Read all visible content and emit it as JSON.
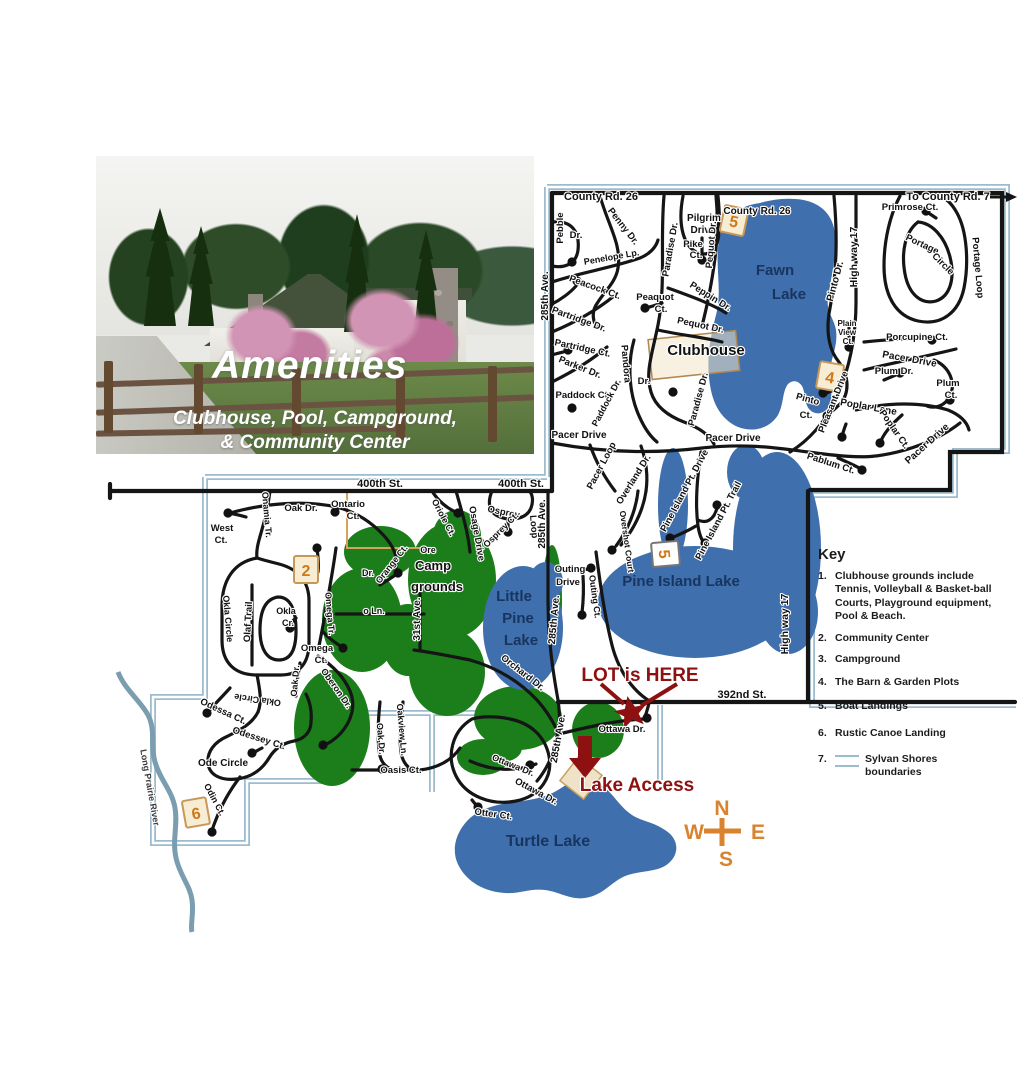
{
  "colors": {
    "lake": "#3f6fad",
    "navy": "#17355e",
    "green": "#1b7e1b",
    "maroon": "#8e1111",
    "orange": "#d9832e",
    "marker_text": "#d07818",
    "marker_fill": "#f7ecd4",
    "marker_border": "#c89858",
    "boundary": "#9cbccd",
    "river": "#7a9db0",
    "road": "#151515",
    "tan": "#d9a05c",
    "gray": "#3a3a3a"
  },
  "photo": {
    "title": "Amenities",
    "subtitle1": "Clubhouse, Pool, Campground,",
    "subtitle2": "& Community Center"
  },
  "key": {
    "title": "Key",
    "items": [
      {
        "num": "1.",
        "text": "Clubhouse grounds include Tennis, Volleyball  & Basket-ball Courts, Playground equipment,  Pool & Beach."
      },
      {
        "num": "2.",
        "text": "Community Center"
      },
      {
        "num": "3.",
        "text": "Campground"
      },
      {
        "num": "4.",
        "text": "The Barn & Garden Plots"
      },
      {
        "num": "5.",
        "text": "Boat Landings"
      },
      {
        "num": "6.",
        "text": "Rustic Canoe Landing"
      },
      {
        "num": "7.",
        "text": "Sylvan Shores boundaries"
      }
    ]
  },
  "map": {
    "markers": [
      {
        "label": "5",
        "x": 734,
        "y": 221,
        "r": 12
      },
      {
        "label": "4",
        "x": 830,
        "y": 377,
        "r": 10
      },
      {
        "label": "5",
        "x": 665,
        "y": 554,
        "r": 85,
        "variant": "light"
      },
      {
        "label": "2",
        "x": 306,
        "y": 570,
        "r": 0
      },
      {
        "label": "6",
        "x": 196,
        "y": 813,
        "r": -10
      }
    ],
    "labels": [
      {
        "t": "County Rd. 26",
        "x": 601,
        "y": 200,
        "s": 11
      },
      {
        "t": "To County Rd. 7",
        "x": 948,
        "y": 200,
        "s": 11
      },
      {
        "t": "County Rd. 26",
        "x": 757,
        "y": 214,
        "s": 10
      },
      {
        "t": "Primrose Ct.",
        "x": 910,
        "y": 210,
        "s": 9.5
      },
      {
        "t": "Pilgrim",
        "x": 704,
        "y": 221,
        "s": 10
      },
      {
        "t": "Drive",
        "x": 703,
        "y": 233,
        "s": 10
      },
      {
        "t": "Pike",
        "x": 693,
        "y": 247,
        "s": 9.5
      },
      {
        "t": "Ct.",
        "x": 696,
        "y": 258,
        "s": 9.5
      },
      {
        "t": "Pebble",
        "x": 563,
        "y": 228,
        "r": -90,
        "s": 9.5
      },
      {
        "t": "Dr.",
        "x": 576,
        "y": 238,
        "s": 9.5
      },
      {
        "t": "Penny Dr.",
        "x": 621,
        "y": 228,
        "r": 52,
        "s": 9.5
      },
      {
        "t": "Penelope Lp.",
        "x": 612,
        "y": 260,
        "r": -10,
        "s": 9
      },
      {
        "t": "Peacock Ct.",
        "x": 594,
        "y": 290,
        "r": 20,
        "s": 9.5
      },
      {
        "t": "Paradise Dr.",
        "x": 673,
        "y": 250,
        "r": -80,
        "s": 9.5
      },
      {
        "t": "Pequot Dr.",
        "x": 714,
        "y": 245,
        "r": -85,
        "s": 9.5
      },
      {
        "t": "Fawn",
        "x": 775,
        "y": 275,
        "s": 15,
        "f": "navy"
      },
      {
        "t": "Lake",
        "x": 789,
        "y": 299,
        "s": 15,
        "f": "navy"
      },
      {
        "t": "Pinto Dr.",
        "x": 838,
        "y": 282,
        "r": -75,
        "s": 10
      },
      {
        "t": "High way 17",
        "x": 857,
        "y": 257,
        "r": -90,
        "s": 10.5
      },
      {
        "t": "Portage",
        "x": 921,
        "y": 247,
        "r": 25,
        "s": 9.5
      },
      {
        "t": "Circle",
        "x": 941,
        "y": 266,
        "r": 45,
        "s": 9.5
      },
      {
        "t": "Portage Loop",
        "x": 975,
        "y": 268,
        "r": 85,
        "s": 9.5
      },
      {
        "t": "Peaquot",
        "x": 655,
        "y": 300,
        "s": 9.5
      },
      {
        "t": "Ct.",
        "x": 661,
        "y": 312,
        "s": 9.5
      },
      {
        "t": "Partridge Dr.",
        "x": 578,
        "y": 322,
        "r": 20,
        "s": 9.5
      },
      {
        "t": "Peppin Dr.",
        "x": 709,
        "y": 299,
        "r": 32,
        "s": 9.5
      },
      {
        "t": "Pequot Dr.",
        "x": 700,
        "y": 328,
        "r": 12,
        "s": 9.5
      },
      {
        "t": "Plain",
        "x": 847,
        "y": 326,
        "s": 8
      },
      {
        "t": "View",
        "x": 847,
        "y": 335,
        "s": 8
      },
      {
        "t": "Ct.",
        "x": 848,
        "y": 344,
        "s": 8
      },
      {
        "t": "Porcupine Ct.",
        "x": 917,
        "y": 340,
        "s": 9.5
      },
      {
        "t": "Partridge Ct.",
        "x": 582,
        "y": 351,
        "r": 12,
        "s": 9.5
      },
      {
        "t": "Parker Dr.",
        "x": 579,
        "y": 370,
        "r": 22,
        "s": 9.5
      },
      {
        "t": "Clubhouse",
        "x": 706,
        "y": 355,
        "s": 15,
        "w": 800
      },
      {
        "t": "Pacer Drive",
        "x": 909,
        "y": 362,
        "r": 10,
        "s": 10
      },
      {
        "t": "Plum Dr.",
        "x": 894,
        "y": 374,
        "s": 9.5
      },
      {
        "t": "Plum",
        "x": 948,
        "y": 386,
        "s": 9.5
      },
      {
        "t": "Ct.",
        "x": 951,
        "y": 398,
        "s": 9.5
      },
      {
        "t": "Pandora",
        "x": 623,
        "y": 364,
        "r": 85,
        "s": 9.5
      },
      {
        "t": "Dr.",
        "x": 644,
        "y": 384,
        "s": 9.5
      },
      {
        "t": "Paddock Ct.",
        "x": 583,
        "y": 398,
        "s": 9.5
      },
      {
        "t": "Paddock Dr.",
        "x": 609,
        "y": 404,
        "r": -62,
        "s": 9
      },
      {
        "t": "Paradise Dr.",
        "x": 701,
        "y": 400,
        "r": -75,
        "s": 9.5
      },
      {
        "t": "Pinto",
        "x": 807,
        "y": 402,
        "r": 15,
        "s": 9.5
      },
      {
        "t": "Ct.",
        "x": 806,
        "y": 418,
        "s": 9.5
      },
      {
        "t": "Pleasant Drive",
        "x": 836,
        "y": 403,
        "r": -68,
        "s": 9.5
      },
      {
        "t": "Poplar Lane",
        "x": 868,
        "y": 410,
        "r": 10,
        "s": 10
      },
      {
        "t": "Poplar Ct.",
        "x": 892,
        "y": 431,
        "r": 55,
        "s": 9.5
      },
      {
        "t": "Pacer Drive",
        "x": 929,
        "y": 446,
        "r": -42,
        "s": 10
      },
      {
        "t": "Pacer Drive",
        "x": 579,
        "y": 438,
        "s": 10
      },
      {
        "t": "Pacer Drive",
        "x": 733,
        "y": 441,
        "s": 10
      },
      {
        "t": "Pacer Loop",
        "x": 604,
        "y": 467,
        "r": -62,
        "s": 9.5
      },
      {
        "t": "Overland Dr.",
        "x": 636,
        "y": 481,
        "r": -58,
        "s": 9.5
      },
      {
        "t": "Pablum Ct.",
        "x": 830,
        "y": 466,
        "r": 18,
        "s": 9.5
      },
      {
        "t": "285th Ave.",
        "x": 548,
        "y": 296,
        "r": -90,
        "s": 10
      },
      {
        "t": "Overshot Court",
        "x": 624,
        "y": 542,
        "r": 82,
        "s": 8.5
      },
      {
        "t": "Pine Island Pt. Drive",
        "x": 687,
        "y": 492,
        "r": -62,
        "s": 9.5
      },
      {
        "t": "Pine Island Pt. Trail",
        "x": 721,
        "y": 522,
        "r": -62,
        "s": 9.5
      },
      {
        "t": "Pine Island Lake",
        "x": 681,
        "y": 586,
        "s": 15,
        "f": "navy"
      },
      {
        "t": "High way 17",
        "x": 788,
        "y": 624,
        "r": -90,
        "s": 10.5
      },
      {
        "t": "Outing",
        "x": 570,
        "y": 572,
        "s": 9.5
      },
      {
        "t": "Drive",
        "x": 568,
        "y": 585,
        "s": 9.5
      },
      {
        "t": "Outing Ct.",
        "x": 592,
        "y": 597,
        "r": 82,
        "s": 9
      },
      {
        "t": "400th St.",
        "x": 380,
        "y": 487,
        "s": 11
      },
      {
        "t": "400th St.",
        "x": 521,
        "y": 487,
        "s": 11
      },
      {
        "t": "West",
        "x": 222,
        "y": 531,
        "s": 9.5
      },
      {
        "t": "Ct.",
        "x": 221,
        "y": 543,
        "s": 9.5
      },
      {
        "t": "Oak Dr.",
        "x": 301,
        "y": 511,
        "s": 9.5
      },
      {
        "t": "Ontario",
        "x": 348,
        "y": 507,
        "s": 9.5
      },
      {
        "t": "Ct.",
        "x": 353,
        "y": 519,
        "s": 9.5
      },
      {
        "t": "Onamia Tr.",
        "x": 264,
        "y": 515,
        "r": 85,
        "s": 9
      },
      {
        "t": "Oriole Ct.",
        "x": 441,
        "y": 519,
        "r": 62,
        "s": 9
      },
      {
        "t": "Osprey",
        "x": 503,
        "y": 515,
        "r": 12,
        "s": 9.5
      },
      {
        "t": "Loop",
        "x": 531,
        "y": 527,
        "r": 85,
        "s": 9.5
      },
      {
        "t": "Osprey Ct.",
        "x": 503,
        "y": 532,
        "r": -45,
        "s": 9
      },
      {
        "t": "285th Ave.",
        "x": 545,
        "y": 524,
        "r": -90,
        "s": 10
      },
      {
        "t": "Osage Drive",
        "x": 474,
        "y": 534,
        "r": 80,
        "s": 9.5
      },
      {
        "t": "Ore",
        "x": 428,
        "y": 553,
        "s": 9
      },
      {
        "t": "Dr.",
        "x": 368,
        "y": 576,
        "s": 9
      },
      {
        "t": "o Ln.",
        "x": 374,
        "y": 614,
        "s": 9
      },
      {
        "t": "Camp",
        "x": 433,
        "y": 570,
        "s": 13,
        "w": 800
      },
      {
        "t": "grounds",
        "x": 437,
        "y": 591,
        "s": 13,
        "w": 800
      },
      {
        "t": "Little",
        "x": 514,
        "y": 601,
        "s": 15,
        "f": "navy"
      },
      {
        "t": "Pine",
        "x": 518,
        "y": 623,
        "s": 15,
        "f": "navy"
      },
      {
        "t": "Lake",
        "x": 521,
        "y": 645,
        "s": 15,
        "f": "navy"
      },
      {
        "t": "285th Ave.",
        "x": 557,
        "y": 620,
        "r": -85,
        "s": 10
      },
      {
        "t": "285th Ave.",
        "x": 561,
        "y": 739,
        "r": -80,
        "s": 10
      },
      {
        "t": "Orchard Dr.",
        "x": 521,
        "y": 675,
        "r": 38,
        "s": 9.5
      },
      {
        "t": "Orange Ct.",
        "x": 394,
        "y": 566,
        "r": -52,
        "s": 9
      },
      {
        "t": "Okla",
        "x": 286,
        "y": 614,
        "s": 9
      },
      {
        "t": "Cr.",
        "x": 288,
        "y": 626,
        "s": 9
      },
      {
        "t": "Olaf Trail",
        "x": 251,
        "y": 622,
        "r": -87,
        "s": 9.5
      },
      {
        "t": "Okla Circle",
        "x": 225,
        "y": 619,
        "r": 85,
        "s": 9
      },
      {
        "t": "Okla Circle",
        "x": 258,
        "y": 697,
        "r": 188,
        "s": 9
      },
      {
        "t": "Omega Tr.",
        "x": 327,
        "y": 614,
        "r": 85,
        "s": 9
      },
      {
        "t": "Omega",
        "x": 317,
        "y": 651,
        "s": 9.5
      },
      {
        "t": "Ct.",
        "x": 321,
        "y": 663,
        "s": 9.5
      },
      {
        "t": "Oberon Dr.",
        "x": 334,
        "y": 690,
        "r": 55,
        "s": 9
      },
      {
        "t": "Oak Dr.",
        "x": 298,
        "y": 681,
        "r": -85,
        "s": 9
      },
      {
        "t": "31st Ave.",
        "x": 420,
        "y": 619,
        "r": -90,
        "s": 10
      },
      {
        "t": "Odessa Ct.",
        "x": 222,
        "y": 714,
        "r": 25,
        "s": 9.5
      },
      {
        "t": "Odessey Ct.",
        "x": 258,
        "y": 741,
        "r": 18,
        "s": 9.5
      },
      {
        "t": "Ode Circle",
        "x": 223,
        "y": 766,
        "s": 10
      },
      {
        "t": "Odin Ct.",
        "x": 212,
        "y": 801,
        "r": 62,
        "s": 9
      },
      {
        "t": "Long Prairie River",
        "x": 147,
        "y": 788,
        "r": 80,
        "s": 9,
        "f": "gray"
      },
      {
        "t": "Oak Dr.",
        "x": 378,
        "y": 739,
        "r": 85,
        "s": 9
      },
      {
        "t": "Oakview Ln.",
        "x": 399,
        "y": 730,
        "r": 85,
        "s": 9
      },
      {
        "t": "Oasis Ct.",
        "x": 401,
        "y": 773,
        "s": 9.5
      },
      {
        "t": "392nd St.",
        "x": 742,
        "y": 698,
        "s": 11
      },
      {
        "t": "Ottawa Dr.",
        "x": 622,
        "y": 732,
        "s": 9.5
      },
      {
        "t": "Ottawa Dr.",
        "x": 512,
        "y": 768,
        "r": 22,
        "s": 9
      },
      {
        "t": "Ottawa Dr.",
        "x": 535,
        "y": 794,
        "r": 28,
        "s": 9.5
      },
      {
        "t": "Otter Ct.",
        "x": 493,
        "y": 817,
        "r": 8,
        "s": 9.5
      },
      {
        "t": "Turtle Lake",
        "x": 548,
        "y": 846,
        "s": 16,
        "f": "navy"
      },
      {
        "t": "LOT is HERE",
        "x": 640,
        "y": 681,
        "s": 19,
        "f": "maroon",
        "w": 800
      },
      {
        "t": "Lake Access",
        "x": 637,
        "y": 791,
        "s": 19,
        "f": "maroon",
        "w": 800
      },
      {
        "t": "N",
        "x": 722,
        "y": 815,
        "s": 21,
        "f": "orange",
        "w": 800
      },
      {
        "t": "W",
        "x": 694,
        "y": 839,
        "s": 21,
        "f": "orange",
        "w": 800
      },
      {
        "t": "E",
        "x": 758,
        "y": 839,
        "s": 21,
        "f": "orange",
        "w": 800
      },
      {
        "t": "S",
        "x": 726,
        "y": 866,
        "s": 21,
        "f": "orange",
        "w": 800
      }
    ]
  }
}
